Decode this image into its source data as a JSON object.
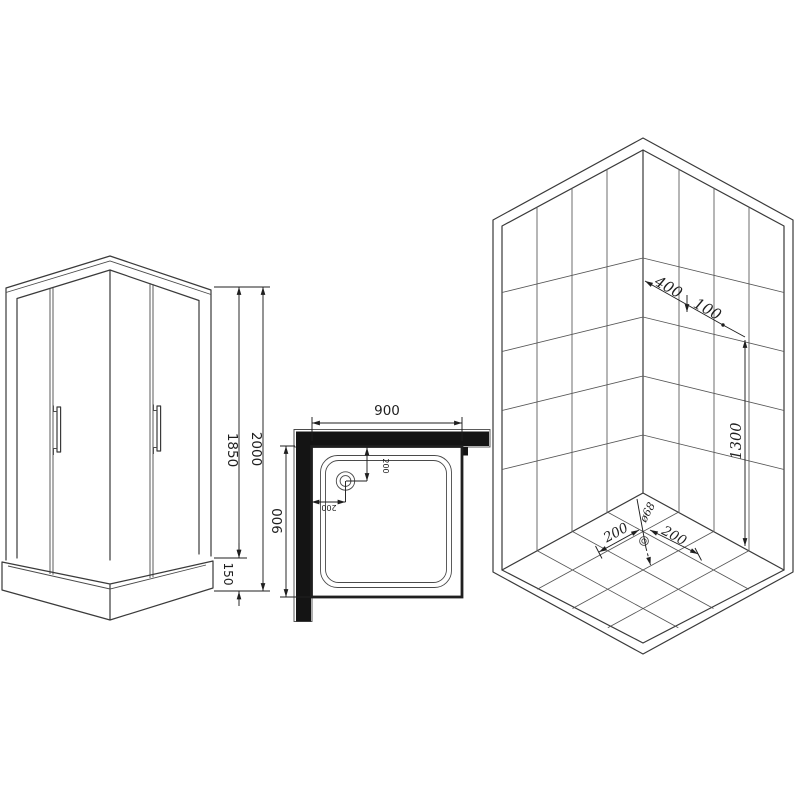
{
  "title": "Corner shower cabin technical drawing (three views)",
  "colors": {
    "line": "#3a3a3a",
    "dim": "#1f1f1f",
    "wall_fill": "#141414",
    "background": "#ffffff"
  },
  "dims": {
    "front_total": "2000",
    "front_glass": "1850",
    "front_tray": "150",
    "top_width": "900",
    "top_depth": "900",
    "top_drain_offset_v": "200",
    "top_drain_offset_h": "200",
    "iso_fixture_offset": "400",
    "iso_fixture_gap": "100",
    "iso_fixture_height": "1300",
    "iso_floor_left": "200",
    "iso_floor_right": "200",
    "iso_drain_diameter": "ø68"
  }
}
